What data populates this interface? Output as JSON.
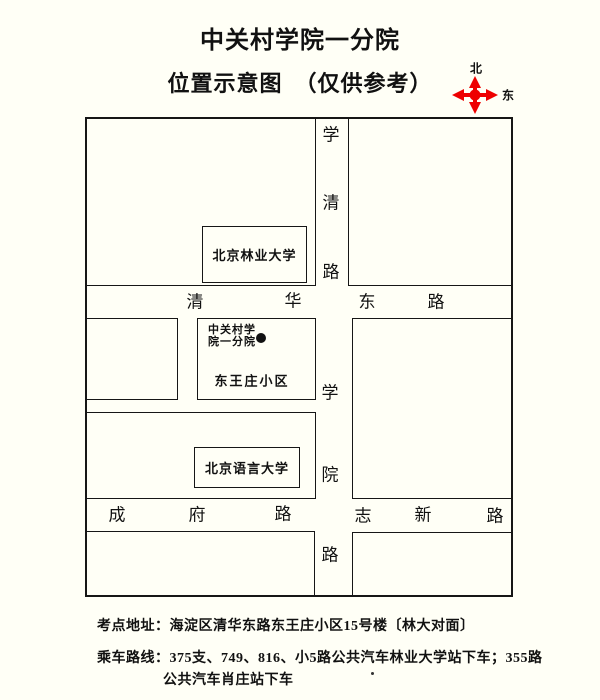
{
  "page": {
    "title": "中关村学院一分院",
    "subtitle": "位置示意图　（仅供参考）",
    "background": "#fffff6",
    "ink": "#111111"
  },
  "compass": {
    "north_label": "北",
    "east_label": "东",
    "color": "#ee0000"
  },
  "map": {
    "buildings": {
      "forestry": "北京林业大学",
      "college_line1": "中关村学",
      "college_line2": "院一分院",
      "residential": "东王庄小区",
      "language_univ": "北京语言大学"
    },
    "roads": {
      "xueqing": [
        "学",
        "清",
        "路"
      ],
      "qinghua_east": [
        "清",
        "华",
        "东",
        "路"
      ],
      "xueyuan": [
        "学",
        "院",
        "路"
      ],
      "chengfu": [
        "成",
        "府",
        "路"
      ],
      "zhixin": [
        "志",
        "新",
        "路"
      ]
    }
  },
  "footer": {
    "address": "考点地址：海淀区清华东路东王庄小区15号楼〔林大对面〕",
    "bus_line1": "乘车路线：375支、749、816、小5路公共汽车林业大学站下车；355路",
    "bus_line2": "公共汽车肖庄站下车"
  }
}
